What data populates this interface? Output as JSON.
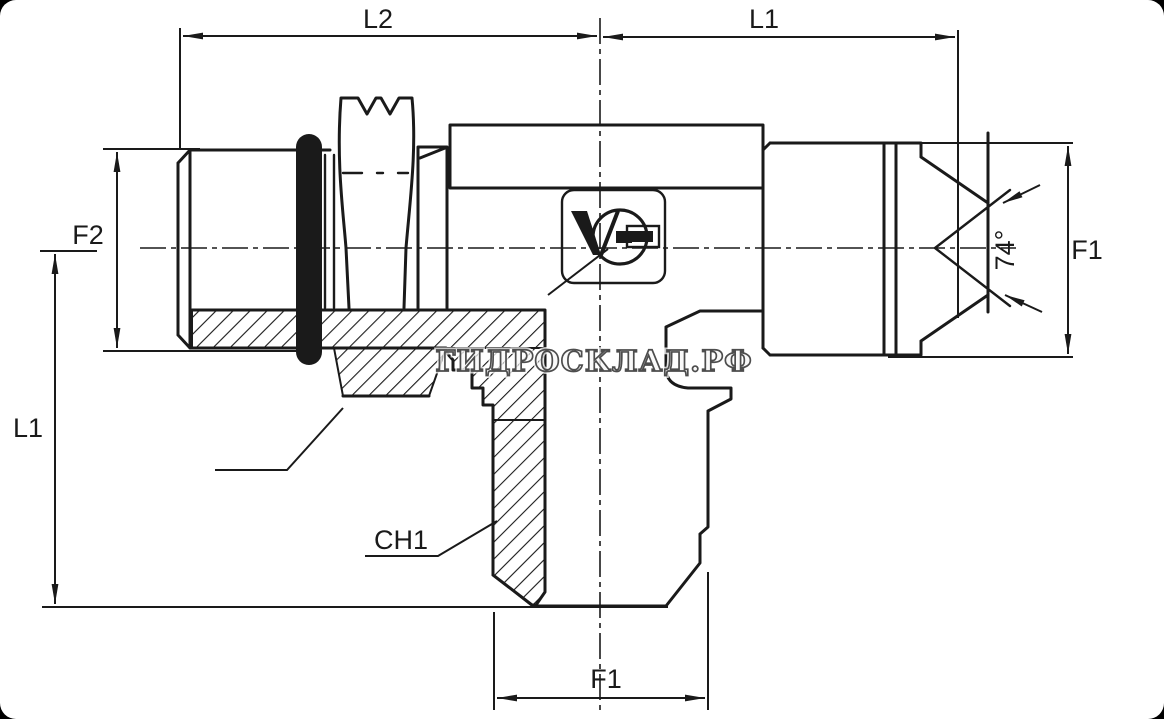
{
  "drawing": {
    "title": "hydraulic tee adapter technical drawing",
    "line_color": "#1a1a1a",
    "background": "#ffffff",
    "frame_color": "#000000",
    "labels": {
      "l2_top": "L2",
      "l1_top": "L1",
      "f2_left": "F2",
      "l1_left": "L1",
      "f1_right": "F1",
      "angle": "74°",
      "ch1": "CH1",
      "f1_bottom": "F1"
    },
    "watermark": {
      "text": "ГИДРОСКЛАД.РФ",
      "color": "#4d4d4d"
    },
    "logo_mark": "V"
  }
}
